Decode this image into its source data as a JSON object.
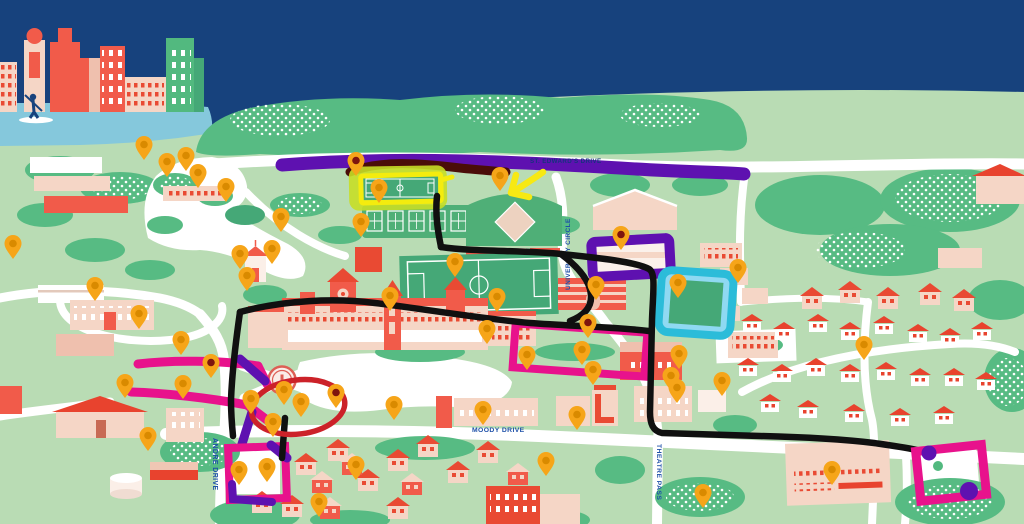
{
  "map": {
    "road_labels": {
      "st_edwards_drive": "ST. EDWARD'S DRIVE",
      "university_circle": "UNIVERSITY CIRCLE",
      "moody_drive": "MOODY DRIVE",
      "theatre_pass": "THEATRE PASS",
      "andre_drive": "ANDRE DRIVE"
    },
    "colors": {
      "sky": "#17427D",
      "water": "#85C8DC",
      "land": "#B9DCB4",
      "tree": "#57BB83",
      "building_coral": "#F15B4A",
      "building_pink": "#F5D6C6",
      "pin": "#F6A519",
      "pin_hole": "#D98A00",
      "pin_hole_dark": "#7E150E",
      "route_black": "#101010",
      "highlight_purple": "#5E11B0",
      "highlight_magenta": "#E8128C",
      "highlight_yellow": "#F4EC0E",
      "highlight_chartreuse": "#C6DE26",
      "highlight_cyan_border": "#2BBCD9",
      "highlight_cyan_fill": "#8FD9F2",
      "annotation_red": "#CC2229",
      "annotation_maroon": "#4A0D08",
      "label_blue": "#1D4FA8"
    },
    "pins": [
      {
        "x": 144,
        "y": 160
      },
      {
        "x": 167,
        "y": 177
      },
      {
        "x": 186,
        "y": 171
      },
      {
        "x": 198,
        "y": 188
      },
      {
        "x": 226,
        "y": 202
      },
      {
        "x": 281,
        "y": 232
      },
      {
        "x": 272,
        "y": 264
      },
      {
        "x": 361,
        "y": 237
      },
      {
        "x": 356,
        "y": 176,
        "v": "dark"
      },
      {
        "x": 379,
        "y": 203
      },
      {
        "x": 500,
        "y": 191
      },
      {
        "x": 13,
        "y": 259
      },
      {
        "x": 95,
        "y": 301
      },
      {
        "x": 139,
        "y": 329
      },
      {
        "x": 181,
        "y": 355
      },
      {
        "x": 125,
        "y": 398
      },
      {
        "x": 240,
        "y": 269
      },
      {
        "x": 247,
        "y": 291
      },
      {
        "x": 390,
        "y": 311
      },
      {
        "x": 455,
        "y": 277
      },
      {
        "x": 497,
        "y": 312
      },
      {
        "x": 487,
        "y": 344
      },
      {
        "x": 621,
        "y": 250,
        "v": "dark"
      },
      {
        "x": 678,
        "y": 298
      },
      {
        "x": 738,
        "y": 283
      },
      {
        "x": 596,
        "y": 300
      },
      {
        "x": 588,
        "y": 338,
        "v": "dark"
      },
      {
        "x": 582,
        "y": 365
      },
      {
        "x": 593,
        "y": 385
      },
      {
        "x": 527,
        "y": 370
      },
      {
        "x": 211,
        "y": 378,
        "v": "dark"
      },
      {
        "x": 183,
        "y": 399
      },
      {
        "x": 251,
        "y": 414
      },
      {
        "x": 284,
        "y": 405
      },
      {
        "x": 301,
        "y": 417
      },
      {
        "x": 336,
        "y": 408,
        "v": "dark"
      },
      {
        "x": 273,
        "y": 437
      },
      {
        "x": 239,
        "y": 485
      },
      {
        "x": 267,
        "y": 482
      },
      {
        "x": 356,
        "y": 480
      },
      {
        "x": 319,
        "y": 517
      },
      {
        "x": 483,
        "y": 425
      },
      {
        "x": 577,
        "y": 430
      },
      {
        "x": 546,
        "y": 476
      },
      {
        "x": 679,
        "y": 369
      },
      {
        "x": 671,
        "y": 391
      },
      {
        "x": 677,
        "y": 403
      },
      {
        "x": 722,
        "y": 396
      },
      {
        "x": 703,
        "y": 508
      },
      {
        "x": 864,
        "y": 360
      },
      {
        "x": 832,
        "y": 485
      },
      {
        "x": 394,
        "y": 420
      },
      {
        "x": 148,
        "y": 451
      }
    ]
  }
}
